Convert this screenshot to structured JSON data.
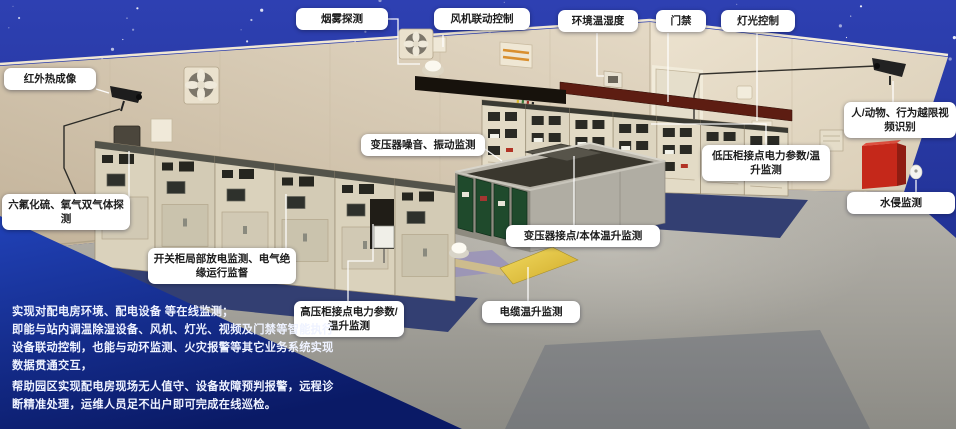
{
  "callouts": {
    "smoke_detection": "烟雾探测",
    "fan_linkage_control": "风机联动控制",
    "env_temp_humidity": "环境温湿度",
    "access_control": "门禁",
    "lighting_control": "灯光控制",
    "infrared_thermal": "红外热成像",
    "dual_gas_detection": "六氟化硫、氧气双气体探测",
    "video_recognition": "人/动物、行为越限视频识别",
    "water_intrusion": "水侵监测",
    "transformer_noise_vibration": "变压器噪音、振动监测",
    "lv_cabinet_power_temp": "低压柜接点电力参数/温升监测",
    "transformer_joint_body_temp": "变压器接点/本体温升监测",
    "switchgear_pd_insulation": "开关柜局部放电监测、电气绝缘运行监督",
    "hv_cabinet_power_temp": "高压柜接点电力参数/温升监测",
    "cable_temp_rise": "电缆温升监测"
  },
  "description": {
    "lines": [
      "实现对配电房环境、配电设备 等在线监测；",
      "即能与站内调温除湿设备、风机、灯光、视频及门禁等智能执行",
      "设备联动控制，也能与动环监测、火灾报警等其它业务系统实现",
      "数据贯通交互，",
      "帮助园区实现配电房现场无人值守、设备故障预判报警，远程诊",
      "断精准处理，运维人员足不出户即可完成在线巡检。"
    ]
  },
  "colors": {
    "sky": "#2b3cab",
    "wall_left": "#d6c8b1",
    "wall_right": "#e6dcc9",
    "floor": "#a3a19a",
    "equipment_mat": "#333f72",
    "text_panel_blue": "#11267e",
    "label_bg": "#ffffff",
    "label_text": "#1c1c1c",
    "transformer_panel_green": "#1f4a2c",
    "fire_box_red": "#c5281a",
    "cable_duct_yellow": "#e7c93f",
    "connector_line": "#ffffff"
  }
}
